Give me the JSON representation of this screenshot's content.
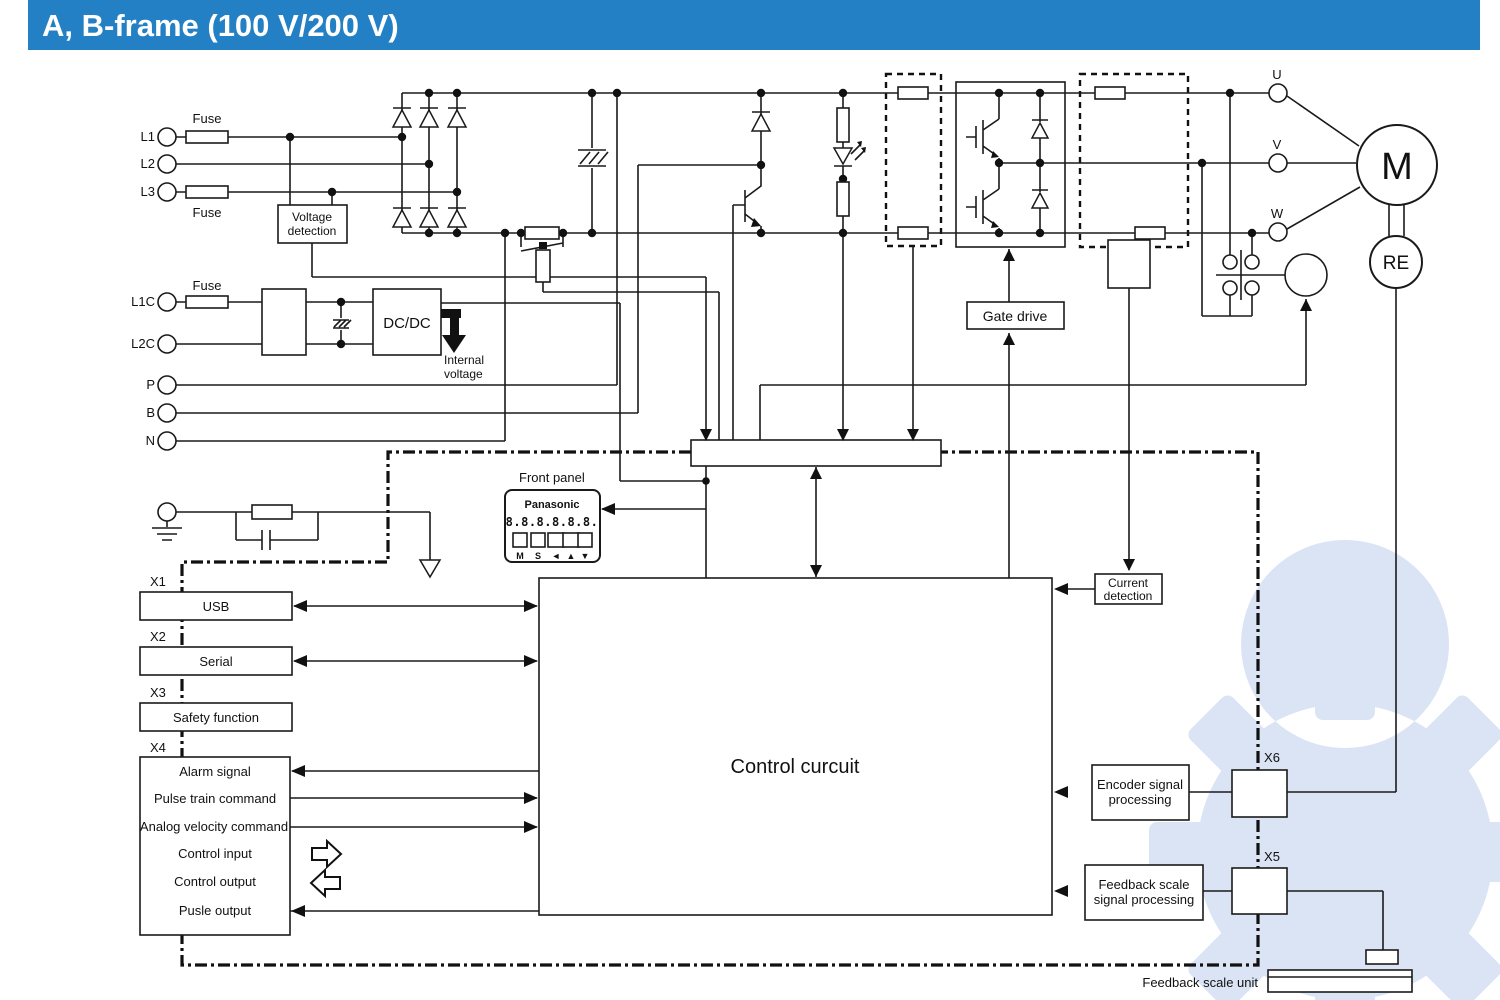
{
  "title": "A, B-frame (100 V/200 V)",
  "colors": {
    "header_bg": "#2380c4",
    "header_text": "#ffffff",
    "diagram_line": "#1a1a1a",
    "watermark": "#b6c9e8"
  },
  "terminals": {
    "l1": "L1",
    "l2": "L2",
    "l3": "L3",
    "l1c": "L1C",
    "l2c": "L2C",
    "p": "P",
    "b": "B",
    "n": "N",
    "u": "U",
    "v": "V",
    "w": "W"
  },
  "fuses": {
    "fuse_l1": "Fuse",
    "fuse_l3": "Fuse",
    "fuse_l1c": "Fuse"
  },
  "blocks": {
    "voltage_detection": [
      "Voltage",
      "detection"
    ],
    "dcdc": "DC/DC",
    "internal_voltage": [
      "Internal",
      "voltage"
    ],
    "gate_drive": "Gate drive",
    "current_detection": [
      "Current",
      "detection"
    ],
    "control_circuit": "Control curcuit",
    "encoder_processing": [
      "Encoder signal",
      "processing"
    ],
    "feedback_processing": [
      "Feedback scale",
      "signal processing"
    ],
    "feedback_scale_unit": "Feedback scale unit"
  },
  "front_panel": {
    "caption": "Front panel",
    "brand": "Panasonic",
    "display": "8.8.8.8.8.8.",
    "buttons": [
      "M",
      "S",
      "◄",
      "▲",
      "▼"
    ]
  },
  "motor": {
    "label": "M",
    "encoder_label": "RE"
  },
  "connectors": {
    "x1": "X1",
    "x2": "X2",
    "x3": "X3",
    "x4": "X4",
    "x5": "X5",
    "x6": "X6",
    "usb": "USB",
    "serial": "Serial",
    "safety": "Safety function",
    "x4_signals": [
      "Alarm signal",
      "Pulse train command",
      "Analog velocity command",
      "Control input",
      "Control output",
      "Pusle output"
    ]
  }
}
